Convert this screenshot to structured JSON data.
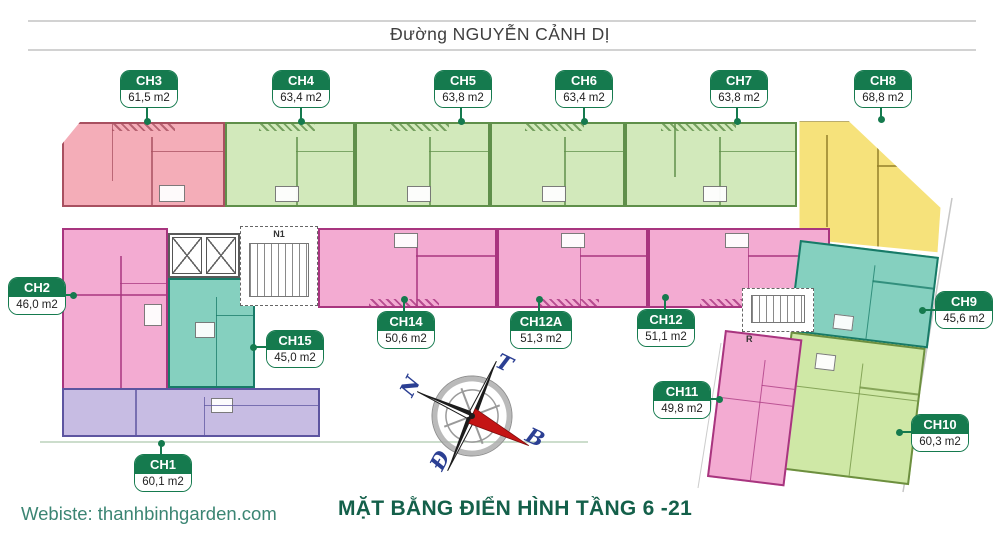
{
  "street": {
    "name": "Đường NGUYỄN CẢNH DỊ"
  },
  "plan": {
    "apartments": [
      {
        "id": "CH1",
        "area": "60,1 m2",
        "fill": "#c7bce3",
        "wall": "#5d55a0"
      },
      {
        "id": "CH2",
        "area": "46,0 m2",
        "fill": "#f3abd2",
        "wall": "#a8357f"
      },
      {
        "id": "CH3",
        "area": "61,5 m2",
        "fill": "#f4adb8",
        "wall": "#a85060"
      },
      {
        "id": "CH4",
        "area": "63,4 m2",
        "fill": "#d2e9bb",
        "wall": "#5f8f4a"
      },
      {
        "id": "CH5",
        "area": "63,8 m2",
        "fill": "#d2e9bb",
        "wall": "#5f8f4a"
      },
      {
        "id": "CH6",
        "area": "63,4 m2",
        "fill": "#d2e9bb",
        "wall": "#5f8f4a"
      },
      {
        "id": "CH7",
        "area": "63,8 m2",
        "fill": "#d2e9bb",
        "wall": "#5f8f4a"
      },
      {
        "id": "CH8",
        "area": "68,8 m2",
        "fill": "#f6e27b",
        "wall": "#937f2a"
      },
      {
        "id": "CH9",
        "area": "45,6 m2",
        "fill": "#85d0bf",
        "wall": "#177a67"
      },
      {
        "id": "CH10",
        "area": "60,3 m2",
        "fill": "#cfe8a6",
        "wall": "#6d8f3f"
      },
      {
        "id": "CH11",
        "area": "49,8 m2",
        "fill": "#f3abd2",
        "wall": "#a8357f"
      },
      {
        "id": "CH12",
        "area": "51,1 m2",
        "fill": "#f3abd2",
        "wall": "#a8357f"
      },
      {
        "id": "CH12A",
        "area": "51,3 m2",
        "fill": "#f3abd2",
        "wall": "#a8357f"
      },
      {
        "id": "CH14",
        "area": "50,6 m2",
        "fill": "#f3abd2",
        "wall": "#a8357f"
      },
      {
        "id": "CH15",
        "area": "45,0 m2",
        "fill": "#85d0bf",
        "wall": "#177a67"
      }
    ],
    "cores": {
      "stair_main_label": "N1",
      "stair_right_label": "R"
    },
    "compass": {
      "letters": {
        "bac": "B",
        "nam": "N",
        "dong": "Đ",
        "tay": "T"
      }
    }
  },
  "footer": {
    "title": "MẶT BẰNG ĐIỂN HÌNH TẦNG 6 -21",
    "website": "Webiste: thanhbinhgarden.com"
  },
  "colors": {
    "badge_green": "#157a4e",
    "title_green": "#14604a",
    "website_teal": "#3b8573",
    "street_line_gray": "#d2d2d2",
    "compass_red": "#c41414",
    "compass_blue": "#2b3f93"
  }
}
